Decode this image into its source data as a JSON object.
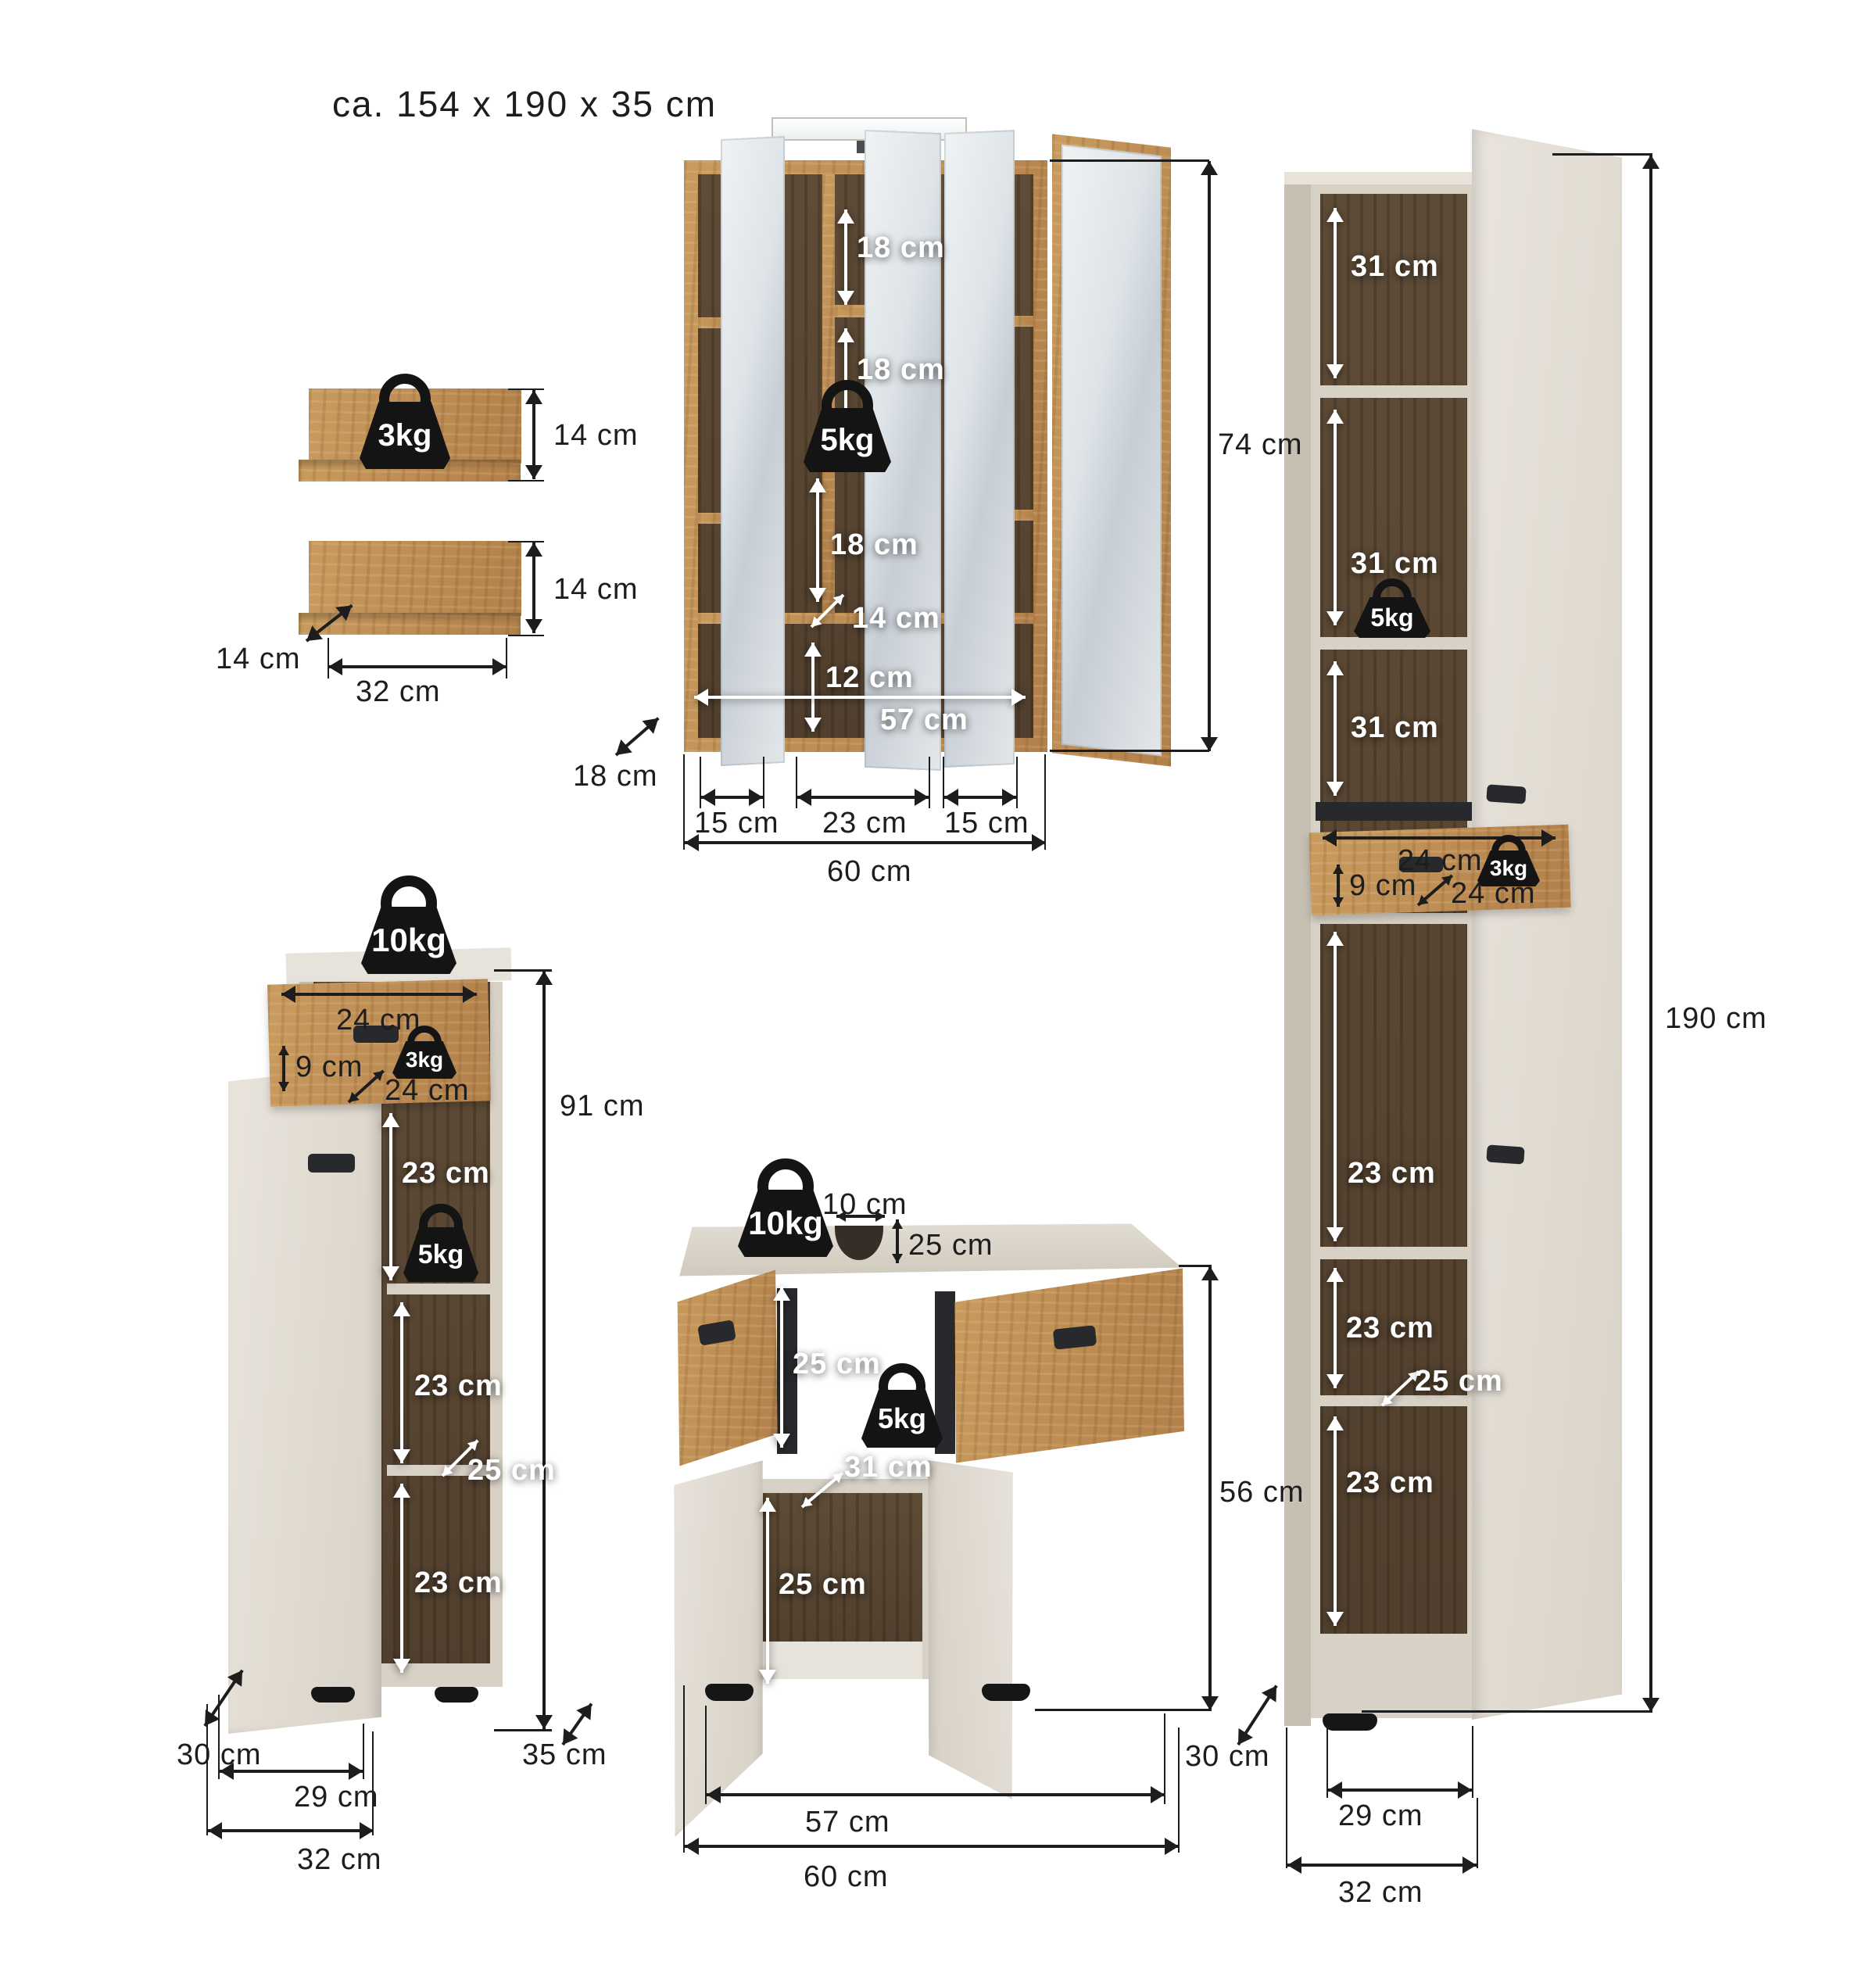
{
  "title": "ca. 154 x 190 x 35 cm",
  "shelf_set": {
    "load": "3kg",
    "top_shelf_height": "14 cm",
    "bottom_shelf_height": "14 cm",
    "depth": "14 cm",
    "width": "32 cm"
  },
  "mirror_cabinet": {
    "load": "5kg",
    "compartments": [
      "18 cm",
      "18 cm",
      "18 cm"
    ],
    "compartment_depth": "14 cm",
    "base_shelf_height": "12 cm",
    "inner_width": "57 cm",
    "column_widths": [
      "15 cm",
      "23 cm",
      "15 cm"
    ],
    "width": "60 cm",
    "depth": "18 cm",
    "height": "74 cm"
  },
  "tall_cabinet": {
    "upper_compartments": [
      "31 cm",
      "31 cm",
      "31 cm"
    ],
    "shelf_load": "5kg",
    "drawer": {
      "width": "24 cm",
      "front_height": "9 cm",
      "depth": "24 cm",
      "load": "3kg"
    },
    "lower_compartments": [
      "23 cm",
      "23 cm",
      "23 cm"
    ],
    "shelf_depth": "25 cm",
    "stand_width": "29 cm",
    "width": "32 cm",
    "depth": "30 cm",
    "height": "190 cm"
  },
  "base_cabinet": {
    "top_load": "10kg",
    "drawer": {
      "width": "24 cm",
      "front_height": "9 cm",
      "depth": "24 cm",
      "load": "3kg"
    },
    "compartments": [
      "23 cm",
      "23 cm",
      "23 cm"
    ],
    "shelf_load": "5kg",
    "shelf_depth": "25 cm",
    "stand_width": "29 cm",
    "width": "32 cm",
    "depth": "30 cm",
    "height": "91 cm"
  },
  "vanity_cabinet": {
    "top_load": "10kg",
    "cutout_width": "10 cm",
    "cutout_inset": "25 cm",
    "upper_compartment_height": "25 cm",
    "shelf_load": "5kg",
    "inner_width": "31 cm",
    "lower_compartment_height": "25 cm",
    "stand_width": "57 cm",
    "width": "60 cm",
    "depth": "35 cm",
    "height": "56 cm"
  }
}
